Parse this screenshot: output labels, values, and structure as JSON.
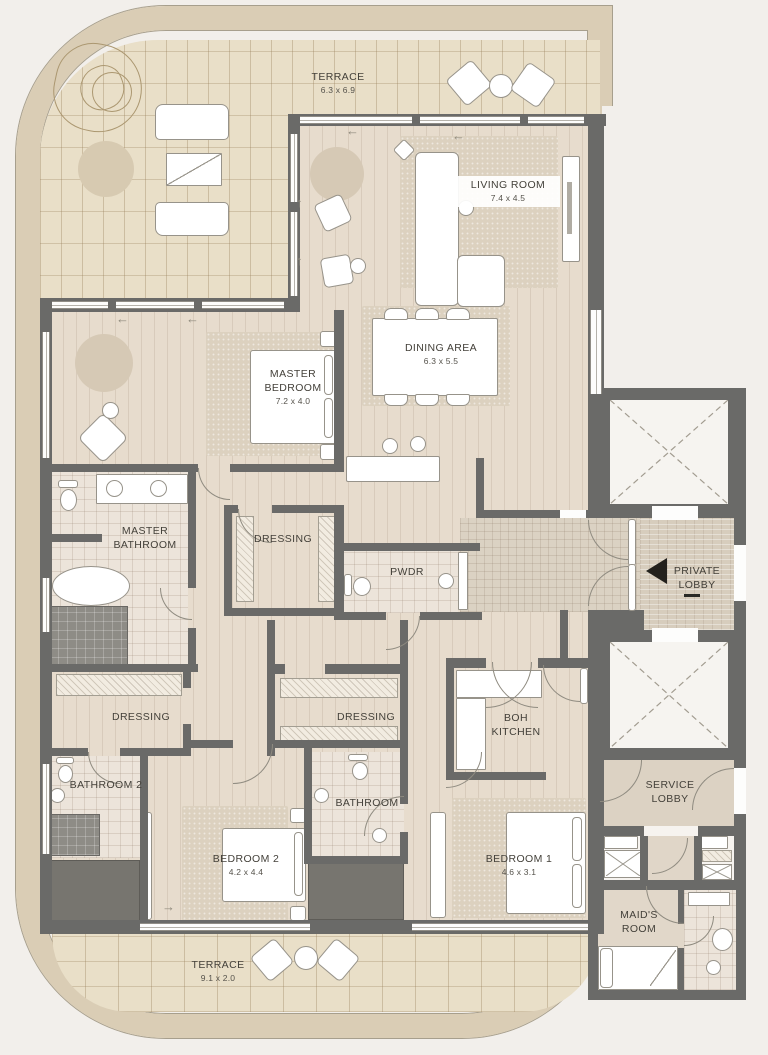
{
  "plan_type": "apartment-floor-plan",
  "rooms": {
    "terrace_top": {
      "name": "TERRACE",
      "dims": "6.3 x 6.9"
    },
    "living_room": {
      "name": "LIVING ROOM",
      "dims": "7.4 x 4.5"
    },
    "dining_area": {
      "name": "DINING AREA",
      "dims": "6.3 x 5.5"
    },
    "master_bedroom": {
      "name": "MASTER BEDROOM",
      "dims": "7.2 x 4.0"
    },
    "master_bathroom": {
      "name": "MASTER BATHROOM"
    },
    "dressing_master": {
      "name": "DRESSING"
    },
    "pwdr": {
      "name": "PWDR"
    },
    "private_lobby": {
      "name": "PRIVATE LOBBY"
    },
    "dressing_left": {
      "name": "DRESSING"
    },
    "dressing_center": {
      "name": "DRESSING"
    },
    "boh_kitchen": {
      "name": "BOH KITCHEN"
    },
    "service_lobby": {
      "name": "SERVICE LOBBY"
    },
    "bathroom_2": {
      "name": "BATHROOM 2"
    },
    "bathroom": {
      "name": "BATHROOM"
    },
    "bedroom_2": {
      "name": "BEDROOM 2",
      "dims": "4.2 x 4.4"
    },
    "bedroom_1": {
      "name": "BEDROOM 1",
      "dims": "4.6 x 3.1"
    },
    "maids_room": {
      "name": "MAID'S ROOM"
    },
    "terrace_bottom": {
      "name": "TERRACE",
      "dims": "9.1 x 2.0"
    }
  },
  "icons": {
    "entrance_marker": "left-pointing solid triangle",
    "elevator_marker": "dashed X cross"
  },
  "colors": {
    "background": "#f2efeb",
    "outer_band": "#dacdb5",
    "wall": "#6a6a68",
    "wood_floor": "#e7dccd",
    "terrace_brick": "#e9dfc8",
    "tile": "#ece4da",
    "rug": "#dcd1bf",
    "entrance_arrow": "#23211d"
  }
}
